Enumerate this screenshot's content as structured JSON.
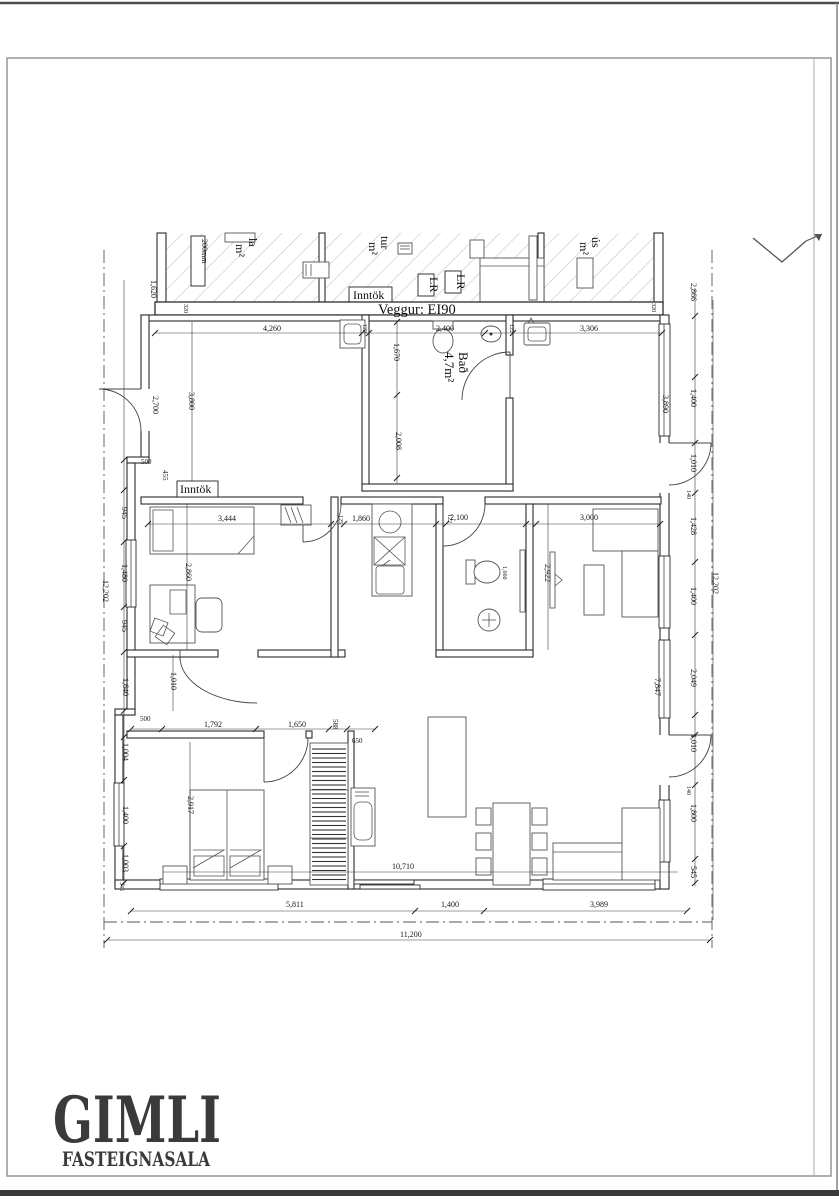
{
  "page": {
    "line_color": "#2b2b2b",
    "hatch_color": "#b5b5b5",
    "frame_color": "#8f8f8f"
  },
  "logo": {
    "name": "GIMLI",
    "subtitle": "FASTEIGNASALA",
    "color": "#3a3a3c"
  },
  "plan": {
    "wall_label": "Veggur:  EI90",
    "labels": {
      "inntok_top": "Inntök",
      "inntok_left": "Inntök",
      "bath_name": "Bað",
      "bath_area": "4,7m²",
      "lr1": "LR",
      "lr2": "LR",
      "mm200": "200mm",
      "frag_la": "la",
      "frag_la_m2": "m²",
      "frag_tur": "tur",
      "frag_tur_m2": "m²",
      "frag_us": "ús",
      "frag_us_m2": "m²"
    },
    "dims": {
      "top_hall": "4,260",
      "top_bath": "2,400",
      "top_right": "3,306",
      "wall_320a": "320",
      "wall_320b": "320",
      "wall_122a": "122",
      "wall_122b": "122",
      "wall_125": "125",
      "wall_122c": "122",
      "mid_room": "3,444",
      "mid_kitchen": "1,860",
      "mid_wc": "2,100",
      "mid_living": "3,000",
      "bath_v_upper": "1,670",
      "bath_v_lower": "2,008",
      "left_overall": "12,202",
      "left_1": "1,620",
      "left_2": "2,700",
      "left_3": "500",
      "left_4": "455",
      "left_5": "945",
      "left_6": "1,480",
      "left_7": "945",
      "left_8": "1,640",
      "left_9": "1,010",
      "left_10": "500",
      "left_11": "1,004",
      "left_12": "1,400",
      "left_13": "1,003",
      "left_14": "345",
      "room_v_hall": "3,800",
      "room_v_room1": "2,860",
      "room_v_bed": "2,917",
      "room_v_wc": "2,922",
      "room_v_toilet": "1,660",
      "right_overall": "12,202",
      "right_1": "2,866",
      "right_2": "1,400",
      "right_3": "1,010",
      "right_4": "1,428",
      "right_5": "1,400",
      "right_6": "2,049",
      "right_7": "1,010",
      "right_8": "1,800",
      "right_9": "545",
      "right_140a": "140",
      "right_140b": "140",
      "right_win_up": "3,890",
      "right_win_low": "7,847",
      "bed_1": "1,792",
      "bed_2": "1,650",
      "bed_3": "588",
      "bed_4": "650",
      "bottom_inner": "10,710",
      "bottom_1": "5,811",
      "bottom_2": "1,400",
      "bottom_3": "3,989",
      "bottom_overall": "11,200"
    }
  }
}
